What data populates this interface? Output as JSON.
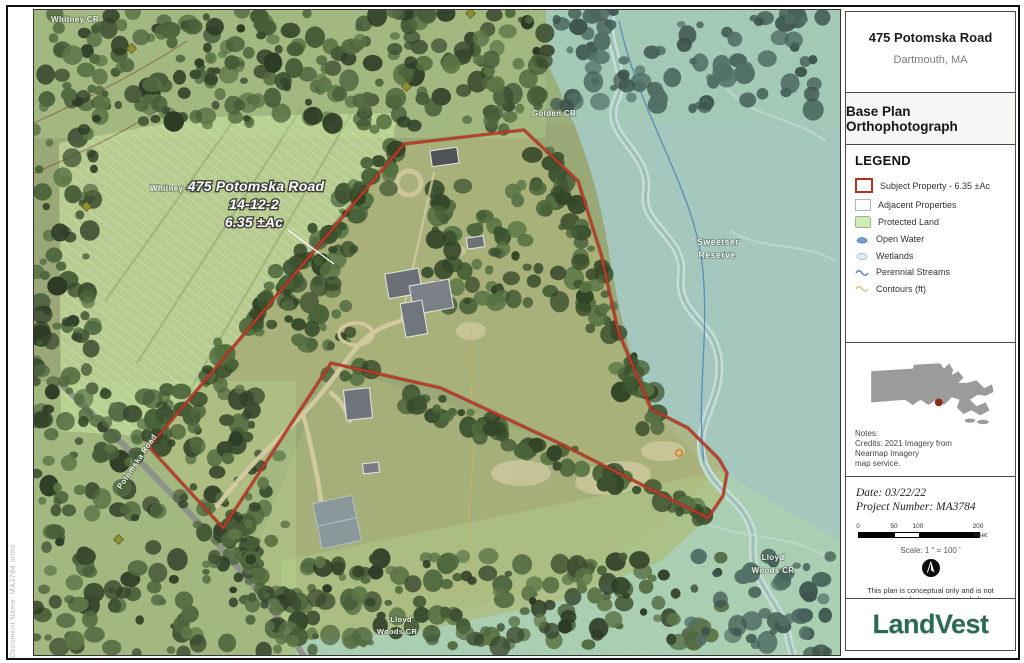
{
  "sheet": {
    "title_block": {
      "title": "475 Potomska Road",
      "subtitle": "Dartmouth,  MA"
    },
    "plan_type": "Base Plan Orthophotograph",
    "legend": {
      "heading": "LEGEND",
      "items": [
        {
          "swatch": "subject",
          "label": "Subject Property - 6.35 ±Ac"
        },
        {
          "swatch": "adjacent",
          "label": "Adjacent Properties"
        },
        {
          "swatch": "protected",
          "label": "Protected Land"
        },
        {
          "swatch": "water",
          "label": "Open Water"
        },
        {
          "swatch": "wetland",
          "label": "Wetlands"
        },
        {
          "swatch": "stream",
          "label": "Perennial Streams"
        },
        {
          "swatch": "contour",
          "label": "Contours (ft)"
        }
      ]
    },
    "locus": {
      "notes": [
        "Notes:",
        "Credits: 2021 Imagery from",
        "Nearmap Imagery",
        "map service."
      ]
    },
    "details": {
      "date_label": "Date: 03/22/22",
      "project_label": "Project Number: MA3784",
      "scale_ticks": [
        "0",
        "50",
        "100",
        "200"
      ],
      "scale_unit": "Feet",
      "scale_text": "Scale: 1 \" = 100 '",
      "disclaimer_line1": "This plan is conceptual only and is not",
      "disclaimer_line2": "represented as an engineered plan."
    },
    "logo_text": "LandVest",
    "side_note": "Document Name: MA3784 ortho"
  },
  "map": {
    "property_label": {
      "line1": "475 Potomska Road",
      "line2": "14-12-2",
      "line3": "6.35 ±Ac"
    },
    "labels": [
      {
        "text": "Whitney CR",
        "x": 74,
        "y": 21,
        "size": 8,
        "rotate": 0
      },
      {
        "text": "Whitney CR",
        "x": 173,
        "y": 190,
        "size": 8,
        "rotate": 0
      },
      {
        "text": "Golden CR",
        "x": 553,
        "y": 115,
        "size": 8,
        "rotate": 0
      },
      {
        "text": "Sweetser",
        "x": 717,
        "y": 244,
        "size": 9,
        "rotate": 0
      },
      {
        "text": "Reserve",
        "x": 716,
        "y": 257,
        "size": 9,
        "rotate": 0
      },
      {
        "text": "Lloyd",
        "x": 772,
        "y": 559,
        "size": 8,
        "rotate": 0
      },
      {
        "text": "Woods CR",
        "x": 772,
        "y": 572,
        "size": 8,
        "rotate": 0
      },
      {
        "text": "Lloyd",
        "x": 400,
        "y": 621,
        "size": 7.5,
        "rotate": 0
      },
      {
        "text": "Woods CR",
        "x": 396,
        "y": 633,
        "size": 7.5,
        "rotate": 0
      },
      {
        "text": "Potomska Road",
        "x": 138,
        "y": 462,
        "size": 8,
        "rotate": -56
      }
    ],
    "prop_label_lines": [
      {
        "text": "475 Potomska Road",
        "x": 255,
        "y": 190,
        "size": 14
      },
      {
        "text": "14-12-2",
        "x": 253,
        "y": 208,
        "size": 14
      },
      {
        "text": "6.35 ±Ac",
        "x": 253,
        "y": 226,
        "size": 14
      }
    ]
  },
  "colors": {
    "subject_red": "#b03325",
    "protected_green": "#cfeab6",
    "water_blue": "#5b8fc9",
    "contour_tan": "#d9c27c",
    "logo_green": "#2b6a52",
    "marsh_teal": "#a3c7bd",
    "locus_dot_red": "#8e2b1f"
  }
}
